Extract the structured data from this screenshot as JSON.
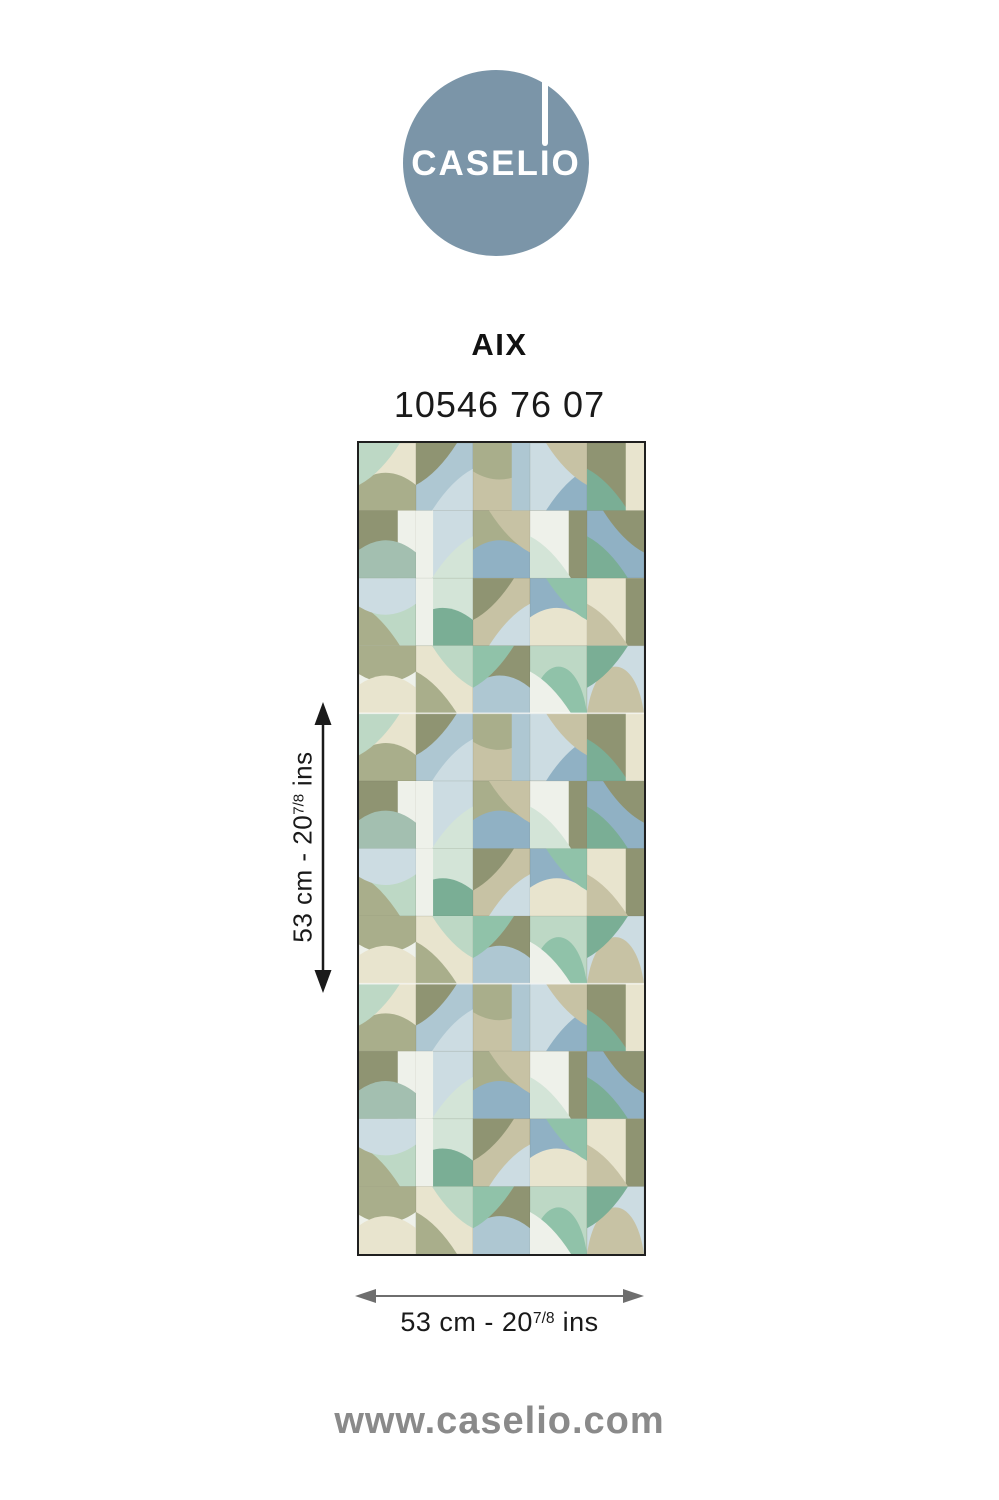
{
  "logo": {
    "brand": "CASELIO",
    "circle_color": "#7b95a8",
    "text_color": "#ffffff"
  },
  "product": {
    "name": "AIX",
    "code": "10546 76 07"
  },
  "dimensions": {
    "vertical": {
      "prefix": "53 cm - 20",
      "fraction": "7/8",
      "suffix": " ins"
    },
    "horizontal": {
      "prefix": "53 cm - 20",
      "fraction": "7/8",
      "suffix": " ins"
    }
  },
  "footer": {
    "website": "www.caselio.com"
  },
  "colors": {
    "background": "#ffffff",
    "text_primary": "#1a1a1a",
    "arrow_vertical": "#1a1a1a",
    "arrow_horizontal": "#6e6e6e",
    "website_gray": "#8a8a8a",
    "swatch_border": "#1f1f1f"
  },
  "swatch": {
    "palette": {
      "olive": "#8f9472",
      "sage": "#a9ae8b",
      "khaki": "#c7c2a4",
      "cream": "#e8e4ce",
      "offwhite": "#eef1ea",
      "paleblue": "#ccdce2",
      "lightblue": "#aec7d2",
      "blue": "#90b1c4",
      "mint": "#bdd8c5",
      "palemint": "#d3e4d7",
      "green": "#90c2a9",
      "teal": "#7aae95",
      "graygreen": "#a3bfb0"
    },
    "grid": {
      "cols": 5,
      "rows": 4,
      "repeats": 3
    },
    "seam_color": "rgba(255,255,255,0.7)",
    "cell_edge_color": "rgba(100,105,80,0.22)",
    "cells": [
      {
        "b": "cream",
        "o": [
          {
            "s": "bandb",
            "c": "sage"
          },
          {
            "s": "tl",
            "c": "mint"
          }
        ]
      },
      {
        "b": "lightblue",
        "o": [
          {
            "s": "tl",
            "c": "olive"
          },
          {
            "s": "br",
            "c": "paleblue"
          }
        ]
      },
      {
        "b": "khaki",
        "o": [
          {
            "s": "bandt",
            "c": "sage"
          },
          {
            "s": "stripr",
            "c": "lightblue"
          }
        ]
      },
      {
        "b": "paleblue",
        "o": [
          {
            "s": "br",
            "c": "blue"
          },
          {
            "s": "tr",
            "c": "khaki"
          }
        ]
      },
      {
        "b": "olive",
        "o": [
          {
            "s": "bl",
            "c": "teal"
          },
          {
            "s": "stripr",
            "c": "cream"
          }
        ]
      },
      {
        "b": "olive",
        "o": [
          {
            "s": "stripr",
            "c": "offwhite"
          },
          {
            "s": "bandb",
            "c": "graygreen"
          }
        ]
      },
      {
        "b": "paleblue",
        "o": [
          {
            "s": "stripl",
            "c": "offwhite"
          },
          {
            "s": "br",
            "c": "palemint"
          }
        ]
      },
      {
        "b": "sage",
        "o": [
          {
            "s": "bandb",
            "c": "blue"
          },
          {
            "s": "tr",
            "c": "khaki"
          }
        ]
      },
      {
        "b": "offwhite",
        "o": [
          {
            "s": "stripr",
            "c": "olive"
          },
          {
            "s": "bl",
            "c": "palemint"
          }
        ]
      },
      {
        "b": "blue",
        "o": [
          {
            "s": "tr",
            "c": "olive"
          },
          {
            "s": "bl",
            "c": "teal"
          }
        ]
      },
      {
        "b": "mint",
        "o": [
          {
            "s": "bl",
            "c": "sage"
          },
          {
            "s": "bandt",
            "c": "paleblue"
          }
        ]
      },
      {
        "b": "palemint",
        "o": [
          {
            "s": "bandb",
            "c": "teal"
          },
          {
            "s": "stripl",
            "c": "offwhite"
          }
        ]
      },
      {
        "b": "khaki",
        "o": [
          {
            "s": "br",
            "c": "paleblue"
          },
          {
            "s": "tl",
            "c": "olive"
          }
        ]
      },
      {
        "b": "blue",
        "o": [
          {
            "s": "bandb",
            "c": "cream"
          },
          {
            "s": "tr",
            "c": "green"
          }
        ]
      },
      {
        "b": "cream",
        "o": [
          {
            "s": "stripr",
            "c": "olive"
          },
          {
            "s": "bl",
            "c": "khaki"
          }
        ]
      },
      {
        "b": "offwhite",
        "o": [
          {
            "s": "bandt",
            "c": "sage"
          },
          {
            "s": "bandb",
            "c": "cream"
          }
        ]
      },
      {
        "b": "cream",
        "o": [
          {
            "s": "bl",
            "c": "sage"
          },
          {
            "s": "tr",
            "c": "mint"
          }
        ]
      },
      {
        "b": "olive",
        "o": [
          {
            "s": "bandb",
            "c": "lightblue"
          },
          {
            "s": "tl",
            "c": "green"
          }
        ]
      },
      {
        "b": "mint",
        "o": [
          {
            "s": "arch",
            "c": "green"
          },
          {
            "s": "bl",
            "c": "offwhite"
          }
        ]
      },
      {
        "b": "paleblue",
        "o": [
          {
            "s": "arch",
            "c": "khaki"
          },
          {
            "s": "tl",
            "c": "teal"
          }
        ]
      }
    ]
  }
}
